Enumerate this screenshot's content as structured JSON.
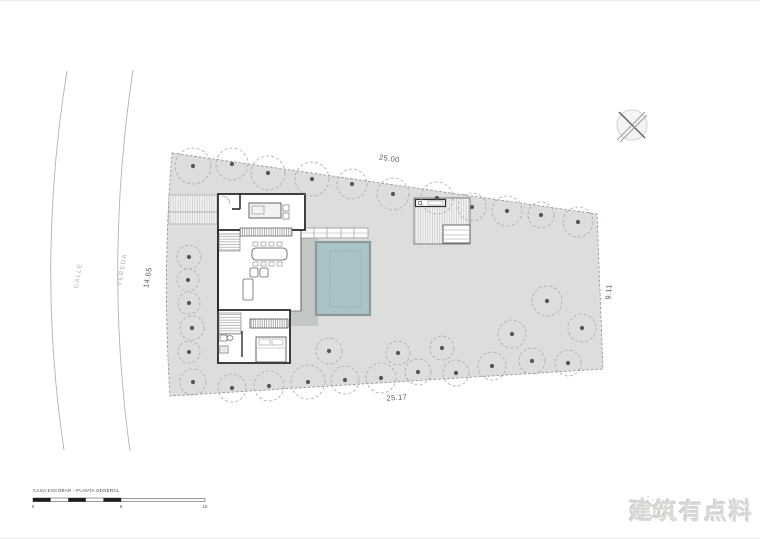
{
  "drawing": {
    "title": "CASA ESCOBAR - PLANTA GENERAL",
    "watermark": {
      "text": "建筑有点料",
      "logo": "bird-sketch-icon"
    },
    "labels": {
      "street": "CALLE",
      "sidewalk": "VEREDA"
    },
    "dimensions": {
      "top": "25.00",
      "left": "14.65",
      "right": "9.11",
      "bottom": "25.17"
    },
    "scale_bar": {
      "ticks": [
        "0",
        "5",
        "10"
      ]
    },
    "colors": {
      "site_fill": "#dcdedc",
      "deck_fill": "#c3c7c4",
      "pool_fill": "#a9c3c7",
      "pool_border": "#8d9a99",
      "wall": "#2b2b2b",
      "tree_outline": "#a6aba6",
      "tree_dot": "#54594f",
      "boundary_line": "#8a8f8a",
      "street_line": "#b0b3b0",
      "watermark_gray": "#d9d9d5"
    },
    "site_boundary": [
      [
        172,
        152
      ],
      [
        597,
        213
      ],
      [
        603,
        368
      ],
      [
        170,
        395
      ]
    ],
    "trees": [
      [
        193,
        165,
        18
      ],
      [
        232,
        163,
        16
      ],
      [
        268,
        172,
        17
      ],
      [
        312,
        178,
        17
      ],
      [
        352,
        183,
        15
      ],
      [
        393,
        193,
        16
      ],
      [
        437,
        197,
        16
      ],
      [
        472,
        206,
        14
      ],
      [
        507,
        210,
        15
      ],
      [
        541,
        214,
        13
      ],
      [
        578,
        221,
        15
      ],
      [
        189,
        256,
        12
      ],
      [
        188,
        279,
        11
      ],
      [
        189,
        302,
        11
      ],
      [
        192,
        327,
        12
      ],
      [
        189,
        351,
        11
      ],
      [
        193,
        381,
        13
      ],
      [
        232,
        387,
        14
      ],
      [
        269,
        385,
        15
      ],
      [
        308,
        381,
        17
      ],
      [
        329,
        350,
        13
      ],
      [
        345,
        379,
        14
      ],
      [
        381,
        377,
        15
      ],
      [
        398,
        352,
        12
      ],
      [
        418,
        371,
        13
      ],
      [
        442,
        347,
        12
      ],
      [
        456,
        372,
        13
      ],
      [
        492,
        365,
        14
      ],
      [
        512,
        333,
        14
      ],
      [
        532,
        360,
        13
      ],
      [
        547,
        300,
        15
      ],
      [
        568,
        362,
        13
      ],
      [
        582,
        327,
        14
      ]
    ]
  }
}
